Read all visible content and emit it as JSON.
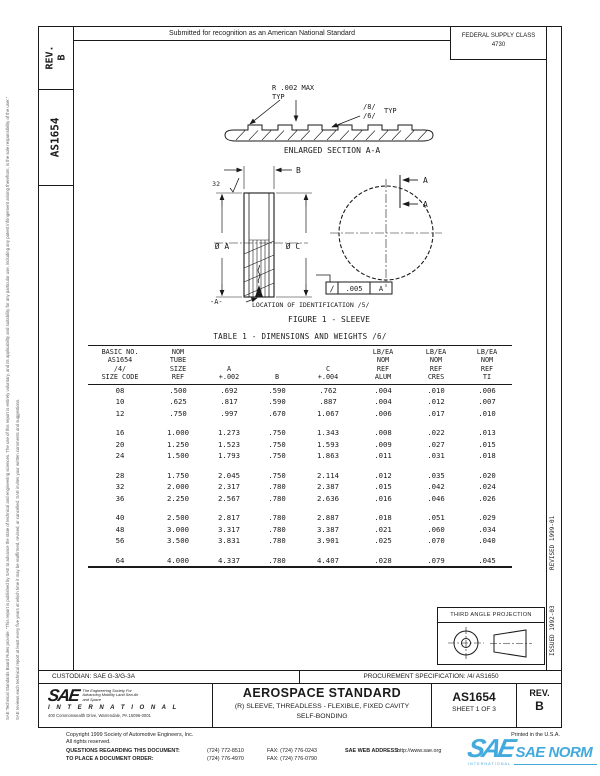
{
  "page": {
    "margin_note_1": "SAE Technical Standards Board Rules provide: “This report is published by SAE to advance the state of technical and engineering sciences. The use of this report is entirely voluntary, and its applicability and suitability for any particular use, including any patent infringement arising therefrom, is the sole responsibility of the user.”",
    "margin_note_2": "SAE reviews each technical report at least every five years at which time it may be reaffirmed, revised, or cancelled. SAE invites your written comments and suggestions."
  },
  "header": {
    "submitted_note": "Submitted for recognition as an American National Standard",
    "federal_supply_class": "FEDERAL SUPPLY CLASS",
    "federal_supply_class_code": "4730"
  },
  "sidebar": {
    "rev": "REV.\nB",
    "doc_number": "AS1654"
  },
  "figure": {
    "radius_note_line1": "R .002 MAX",
    "radius_note_line2": "TYP",
    "flag_8": "/8/",
    "flag_6": "/6/",
    "typ": "TYP",
    "enlarged_caption": "ENLARGED SECTION A-A",
    "dim_b": "B",
    "surface_finish": "32",
    "dia_a": "Ø A",
    "dia_c": "Ø C",
    "datum_a": "-A-",
    "section_a_top": "A",
    "section_a_bottom": "A",
    "fcf_symbol": "∕",
    "fcf_tolerance": ".005",
    "fcf_datum": "A",
    "location_note": "LOCATION OF  IDENTIFICATION /5/",
    "caption": "FIGURE 1 - SLEEVE"
  },
  "table": {
    "title": "TABLE 1 - DIMENSIONS AND WEIGHTS /6/",
    "headers": [
      "BASIC NO.\nAS1654\n/4/\nSIZE CODE",
      "NOM\nTUBE\nSIZE\nREF",
      "A\n+.002",
      "B",
      "C\n+.004",
      "LB/EA\nNOM\nREF\nALUM",
      "LB/EA\nNOM\nREF\nCRES",
      "LB/EA\nNOM\nREF\nTI"
    ],
    "groups": [
      [
        [
          "08",
          ".500",
          ".692",
          ".590",
          ".762",
          ".004",
          ".010",
          ".006"
        ],
        [
          "10",
          ".625",
          ".817",
          ".590",
          ".887",
          ".004",
          ".012",
          ".007"
        ],
        [
          "12",
          ".750",
          ".997",
          ".670",
          "1.067",
          ".006",
          ".017",
          ".010"
        ]
      ],
      [
        [
          "16",
          "1.000",
          "1.273",
          ".750",
          "1.343",
          ".008",
          ".022",
          ".013"
        ],
        [
          "20",
          "1.250",
          "1.523",
          ".750",
          "1.593",
          ".009",
          ".027",
          ".015"
        ],
        [
          "24",
          "1.500",
          "1.793",
          ".750",
          "1.863",
          ".011",
          ".031",
          ".018"
        ]
      ],
      [
        [
          "28",
          "1.750",
          "2.045",
          ".750",
          "2.114",
          ".012",
          ".035",
          ".020"
        ],
        [
          "32",
          "2.000",
          "2.317",
          ".780",
          "2.387",
          ".015",
          ".042",
          ".024"
        ],
        [
          "36",
          "2.250",
          "2.567",
          ".780",
          "2.636",
          ".016",
          ".046",
          ".026"
        ]
      ],
      [
        [
          "40",
          "2.500",
          "2.817",
          ".780",
          "2.887",
          ".018",
          ".051",
          ".029"
        ],
        [
          "48",
          "3.000",
          "3.317",
          ".780",
          "3.387",
          ".021",
          ".060",
          ".034"
        ],
        [
          "56",
          "3.500",
          "3.831",
          ".780",
          "3.901",
          ".025",
          ".070",
          ".040"
        ]
      ],
      [
        [
          "64",
          "4.000",
          "4.337",
          ".780",
          "4.407",
          ".028",
          ".079",
          ".045"
        ]
      ]
    ]
  },
  "projection": {
    "label": "THIRD ANGLE PROJECTION"
  },
  "margin_right": {
    "revised": "REVISED 1999-01",
    "issued": "ISSUED 1992-03"
  },
  "title_block": {
    "custodian": "CUSTODIAN: SAE G-3/G-3A",
    "procurement": "PROCUREMENT SPECIFICATION: /4/ AS1650",
    "standard_type": "AEROSPACE STANDARD",
    "title_line1": "(R) SLEEVE, THREADLESS - FLEXIBLE, FIXED CAVITY",
    "title_line2": "SELF-BONDING",
    "doc_number": "AS1654",
    "sheet": "SHEET 1 OF 3",
    "rev_label": "REV.",
    "rev_value": "B",
    "sae_word": "SAE",
    "sae_tagline": "The Engineering Society For Advancing Mobility Land Sea Air and Space",
    "sae_international": "I N T E R N A T I O N A L",
    "sae_address": "400 Commonwealth Drive, Warrendale, PA 15096-0001"
  },
  "footer": {
    "copyright": "Copyright 1999 Society of Automotive Engineers, Inc.",
    "rights": "All rights reserved.",
    "printed": "Printed in the U.S.A.",
    "questions_label": "QUESTIONS REGARDING THIS DOCUMENT:",
    "questions_phone": "(724) 772-8510",
    "questions_fax": "FAX: (724) 776-0243",
    "order_label": "TO PLACE A DOCUMENT ORDER:",
    "order_phone": "(724) 776-4970",
    "order_fax": "FAX: (724) 776-0790",
    "web_label": "SAE WEB ADDRESS:",
    "web_value": "http://www.sae.org"
  },
  "watermark": {
    "brand": "SAE",
    "name": "SAE NORM",
    "sub": "INTERNATIONAL",
    "color": "#42aadd"
  }
}
